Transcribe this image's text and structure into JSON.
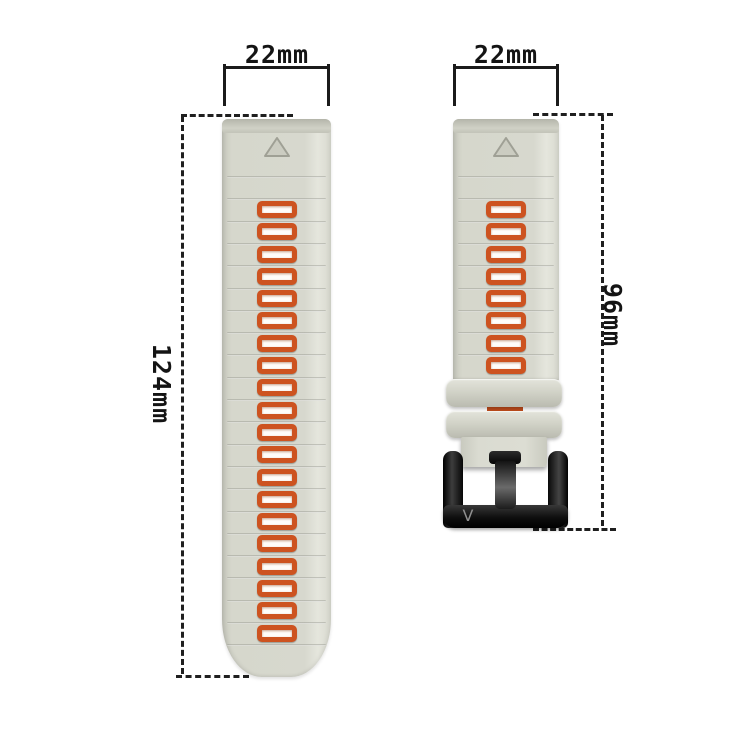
{
  "labels": {
    "left_strap_width": "22mm",
    "right_strap_width": "22mm",
    "left_strap_length": "124mm",
    "right_strap_length": "96mm"
  },
  "left_strap": {
    "hole_count": 20,
    "groove_count": 22
  },
  "right_strap": {
    "hole_count": 8,
    "groove_count": 9,
    "keeper_count": 2
  },
  "buckle": {
    "logo": "V"
  },
  "colors": {
    "strap": "#d7d8ce",
    "strap_highlight": "#e5e6dd",
    "strap_shadow": "#c7c8bd",
    "groove": "#b2b3a8",
    "hole_border": "#cd5320",
    "hole_fill": "#fffdfa",
    "buckle_black": "#1a1a1a",
    "dimension_ink": "#1b1b1b",
    "background": "#ffffff"
  }
}
